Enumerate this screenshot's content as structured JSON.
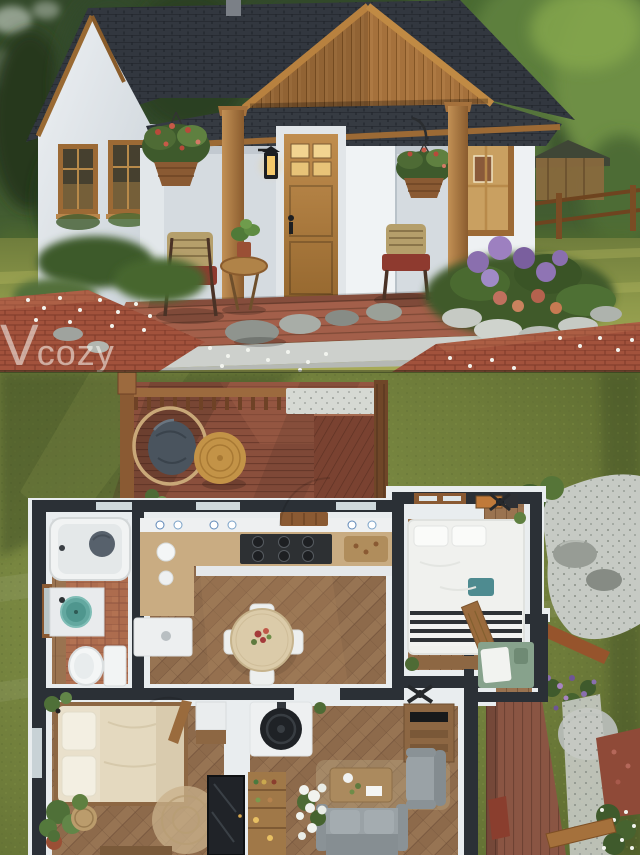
{
  "meta": {
    "description": "Cozy tiny cottage render: exterior photo on top, 3D top-down floor plan below",
    "width": 640,
    "height": 855
  },
  "watermark": {
    "v": "V",
    "rest": "cozy",
    "full": "Vcozy"
  },
  "palette": {
    "forest_dark": "#2a4023",
    "forest_light": "#7d9a52",
    "roof_shingle": "#363b42",
    "wood_trim": "#a5713c",
    "wall_white": "#e9edf0",
    "door_oak": "#b9854a",
    "porch_deck": "#9d5f4a",
    "lawn_green": "#8f9a4b",
    "brick_path": "#a2523c",
    "hydrangea_purple": "#8a6fae",
    "plan_grass": "#6e7c3a",
    "plan_deck": "#8a4f3c",
    "plan_wall_dark": "#2b3036",
    "herringbone_floor": "#8d6a4b",
    "bath_tile": "#ad6c4e",
    "sink_teal": "#63a8a0",
    "sofa_gray": "#9aa2a6",
    "bed_cream": "#e9e0cb",
    "stove_black": "#1f2226",
    "gravel_gray": "#c6cac4"
  },
  "semantics": {
    "sections": [
      "cottage-exterior-photo",
      "floor-plan-render"
    ],
    "exterior_elements": [
      "forest-backdrop",
      "gable-roof",
      "porch-gable",
      "front-door",
      "porch-lantern",
      "hanging-flower-baskets",
      "porch-chairs",
      "side-table",
      "windows",
      "stone-flower-bed",
      "brick-path",
      "lawn",
      "fence",
      "garden-shed"
    ],
    "floor_plan_areas": [
      "rear-deck",
      "hanging-egg-chair",
      "round-side-table",
      "bathroom",
      "kitchen-dining",
      "bedroom-top",
      "entry-alcove",
      "bedroom-main",
      "living-room",
      "wood-stove",
      "entry-porch-deck",
      "gravel-garden"
    ]
  }
}
